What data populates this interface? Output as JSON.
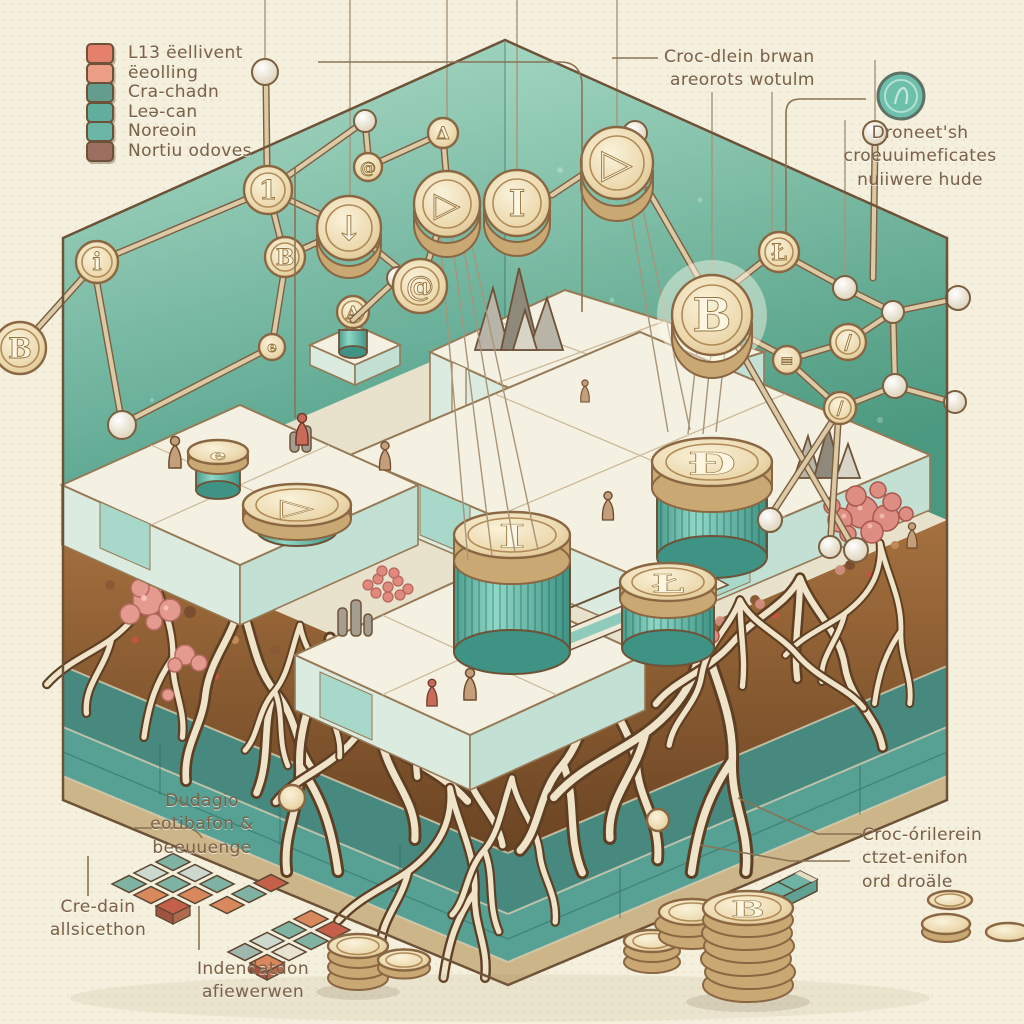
{
  "palette": {
    "background": "#f4f0dd",
    "wall_teal": "#5aa78f",
    "soil_brown": "#8a5a36",
    "accent_salmon": "#e4806b",
    "accent_teal": "#6cb6a8",
    "coin_gold": "#e6cfa4",
    "root_cream": "#efe3c9"
  },
  "legend": {
    "items": [
      {
        "label": "L13 ëellivent",
        "color": "#e4806b"
      },
      {
        "label": "ëeolling",
        "color": "#eb9f86"
      },
      {
        "label": "Cra-chadn",
        "color": "#649d8e"
      },
      {
        "label": "Leə-can",
        "color": "#5fae9e"
      },
      {
        "label": "Noreoin",
        "color": "#6cb6a8"
      },
      {
        "label": "Nortiu odoves",
        "color": "#9c6f60"
      }
    ]
  },
  "annotations": {
    "top_right_network": {
      "lines": [
        "Croc-dlein brwan",
        "areorots wotulm"
      ]
    },
    "top_right_token": {
      "lines": [
        "Droneet'sh",
        "croeuuimeficates",
        "nuiiwere hude"
      ]
    },
    "bottom_left_primary": {
      "lines": [
        "Dudagio",
        "eotibafon &",
        "beeuuenge"
      ]
    },
    "bottom_left_secondary": {
      "lines": [
        "Cre-dain",
        "allsicethon"
      ]
    },
    "bottom_left_tertiary": {
      "lines": [
        "Indendatdon",
        "afiewerwen"
      ]
    },
    "bottom_right": {
      "lines": [
        "Croc-órilerein",
        "ctzet-enifon",
        "ord droäle"
      ]
    }
  },
  "coins": {
    "bitcoin": "B",
    "dogecoin": "Đ",
    "litecoin": "Ł",
    "iota": "I",
    "play": "▷",
    "delta": "Δ",
    "at": "@",
    "info": "i",
    "one": "1",
    "slash": "/",
    "hash": "≡",
    "e": "e",
    "a": "A",
    "down": "↓"
  }
}
